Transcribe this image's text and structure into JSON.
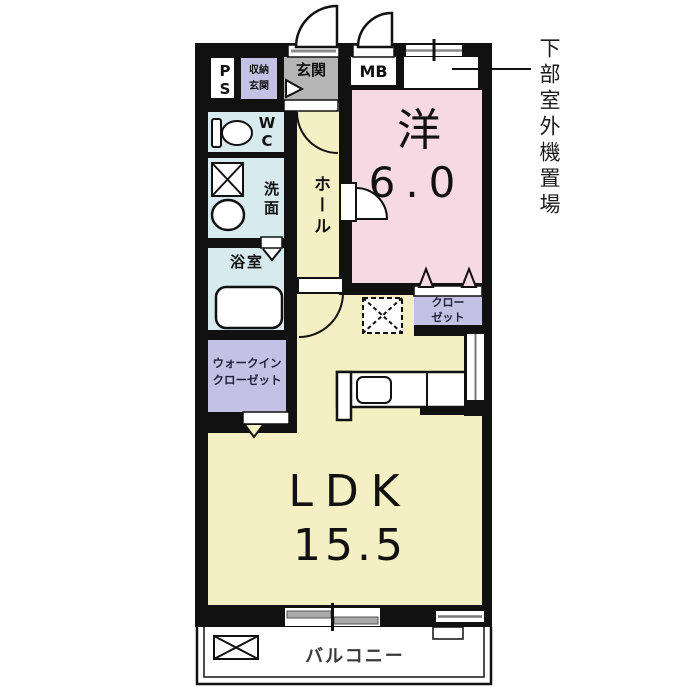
{
  "colors": {
    "wall": "#111111",
    "western_room_fill": "#f6d9e3",
    "ldk_fill": "#f5f0c3",
    "wet_area_fill": "#d7eaee",
    "closet_fill": "#c4c2e4",
    "entrance_floor_fill": "#b5b5b5",
    "window_gray": "#999999"
  },
  "rooms": {
    "western": {
      "name": "洋",
      "size": "6.0"
    },
    "ldk": {
      "name": "LDK",
      "size": "15.5"
    },
    "hall": {
      "name": "ホール"
    },
    "entrance": {
      "name": "玄関"
    },
    "entrance_storage": {
      "line1": "収納",
      "line2": "玄関"
    },
    "pipe_space": {
      "name": "PS"
    },
    "meter_box": {
      "name": "MB"
    },
    "toilet": {
      "name": "WC"
    },
    "washroom": {
      "name": "洗面"
    },
    "bathroom": {
      "name": "浴室"
    },
    "walk_in_closet": {
      "line1": "ウォークイン",
      "line2": "クローゼット"
    },
    "closet": {
      "line1": "クロー",
      "line2": "ゼット"
    },
    "balcony": {
      "name": "バルコニー"
    }
  },
  "annotations": {
    "outdoor_unit": "下部室外機置場"
  }
}
